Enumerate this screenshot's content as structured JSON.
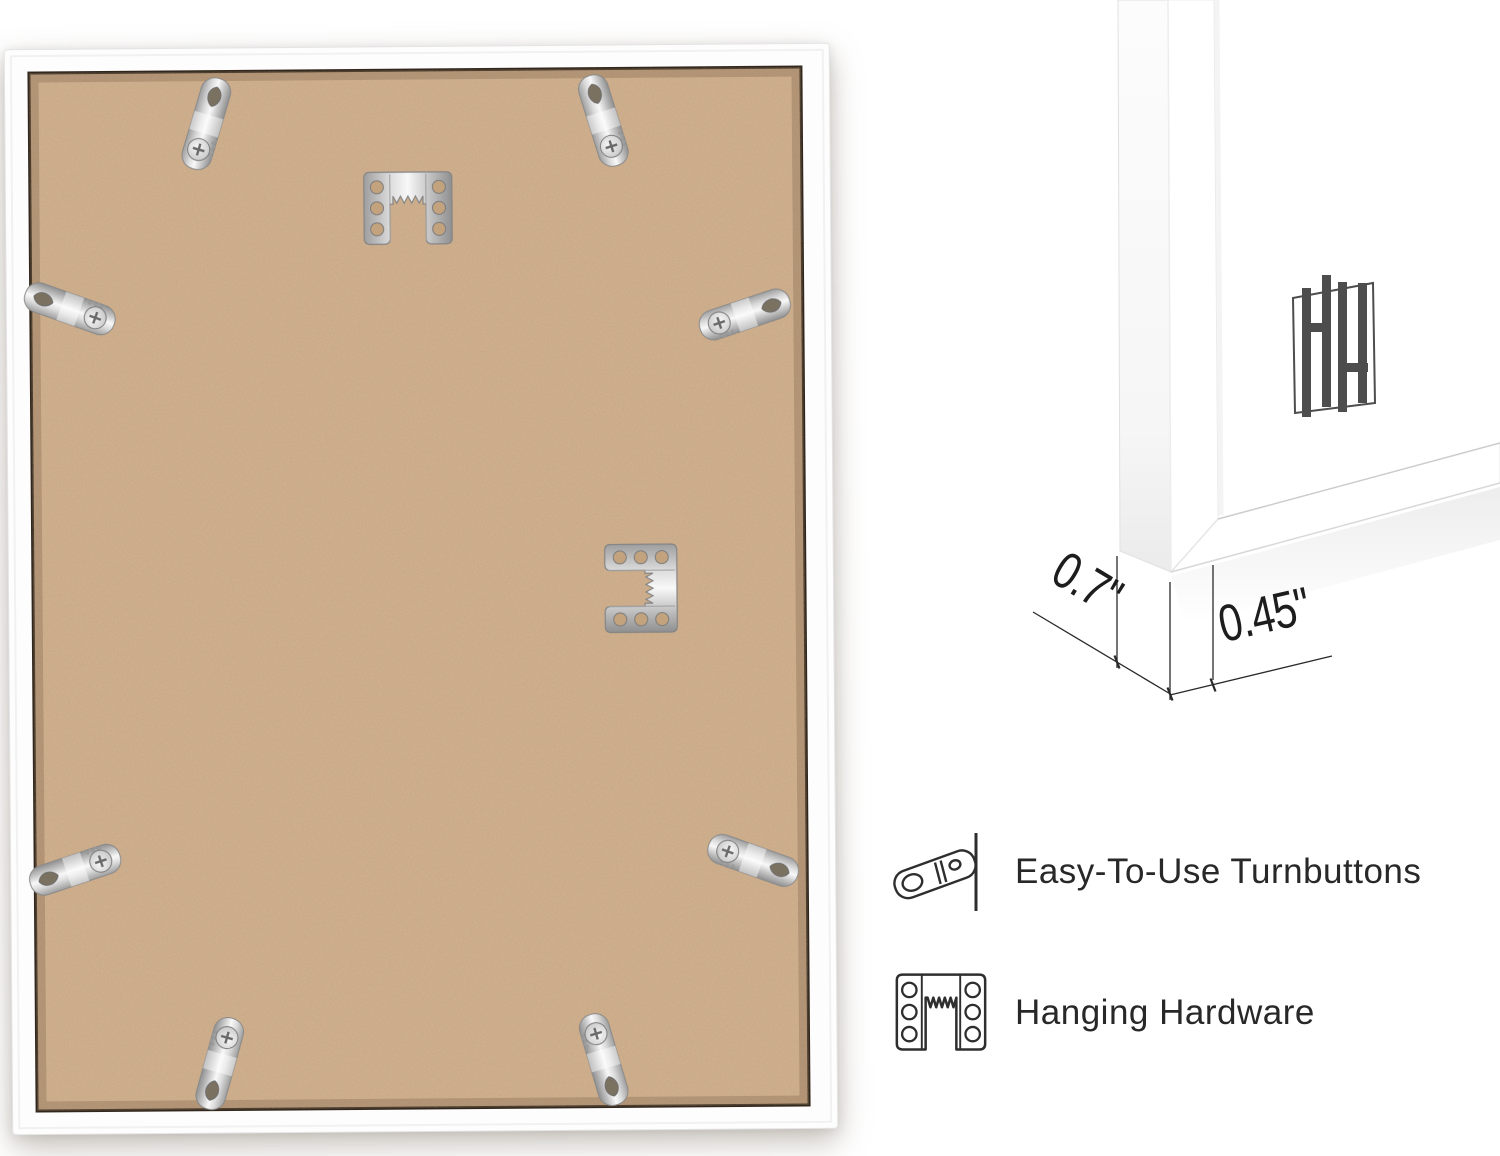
{
  "product_photo": {
    "subject": "back of white picture frame with MDF backing board",
    "turnbutton_count": 8,
    "sawtooth_hanger_count": 2
  },
  "closeup": {
    "subject": "front corner of white frame with white mat",
    "brand_logo": "HH-monogram",
    "measurements": {
      "depth": "0.7\"",
      "face_width": "0.45\""
    }
  },
  "features": [
    {
      "icon": "turnbutton-icon",
      "label": "Easy-To-Use Turnbuttons"
    },
    {
      "icon": "hanging-hardware-icon",
      "label": "Hanging Hardware"
    }
  ],
  "colors": {
    "board": "#cdaa85",
    "frame_white": "#ffffff",
    "metal": "#c6c6c6",
    "seam": "#33271b",
    "label_text": "#282828",
    "dimension_text": "#1d1d1d",
    "logo": "#4d4d4d"
  }
}
